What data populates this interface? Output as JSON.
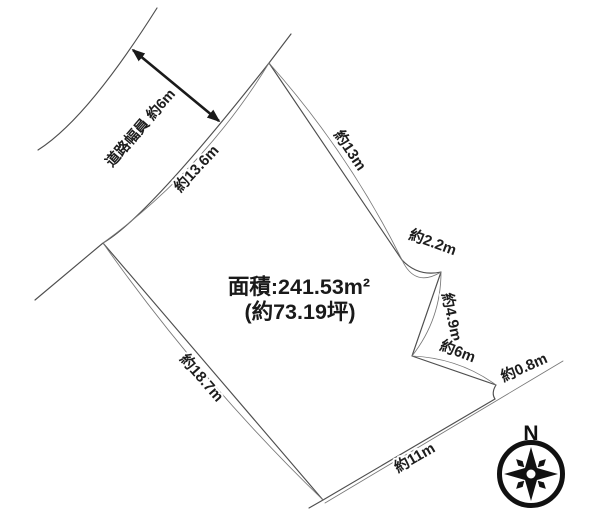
{
  "diagram": {
    "area": {
      "line1": "面積:241.53m²",
      "line2": "(約73.19坪)"
    },
    "road": {
      "width_label": "道路幅員 約6m"
    },
    "dimensions": {
      "frontage": "約13.6m",
      "northeast": "約13m",
      "notch_a": "約2.2m",
      "notch_b": "約4.9m",
      "notch_c": "約6m",
      "notch_d": "約0.8m",
      "south": "約11m",
      "southwest": "約18.7m"
    },
    "compass": {
      "north_label": "N"
    },
    "colors": {
      "background": "#ffffff",
      "boundary_line": "#4e4e4e",
      "text": "#1d1d1d",
      "compass": "#111111"
    }
  }
}
